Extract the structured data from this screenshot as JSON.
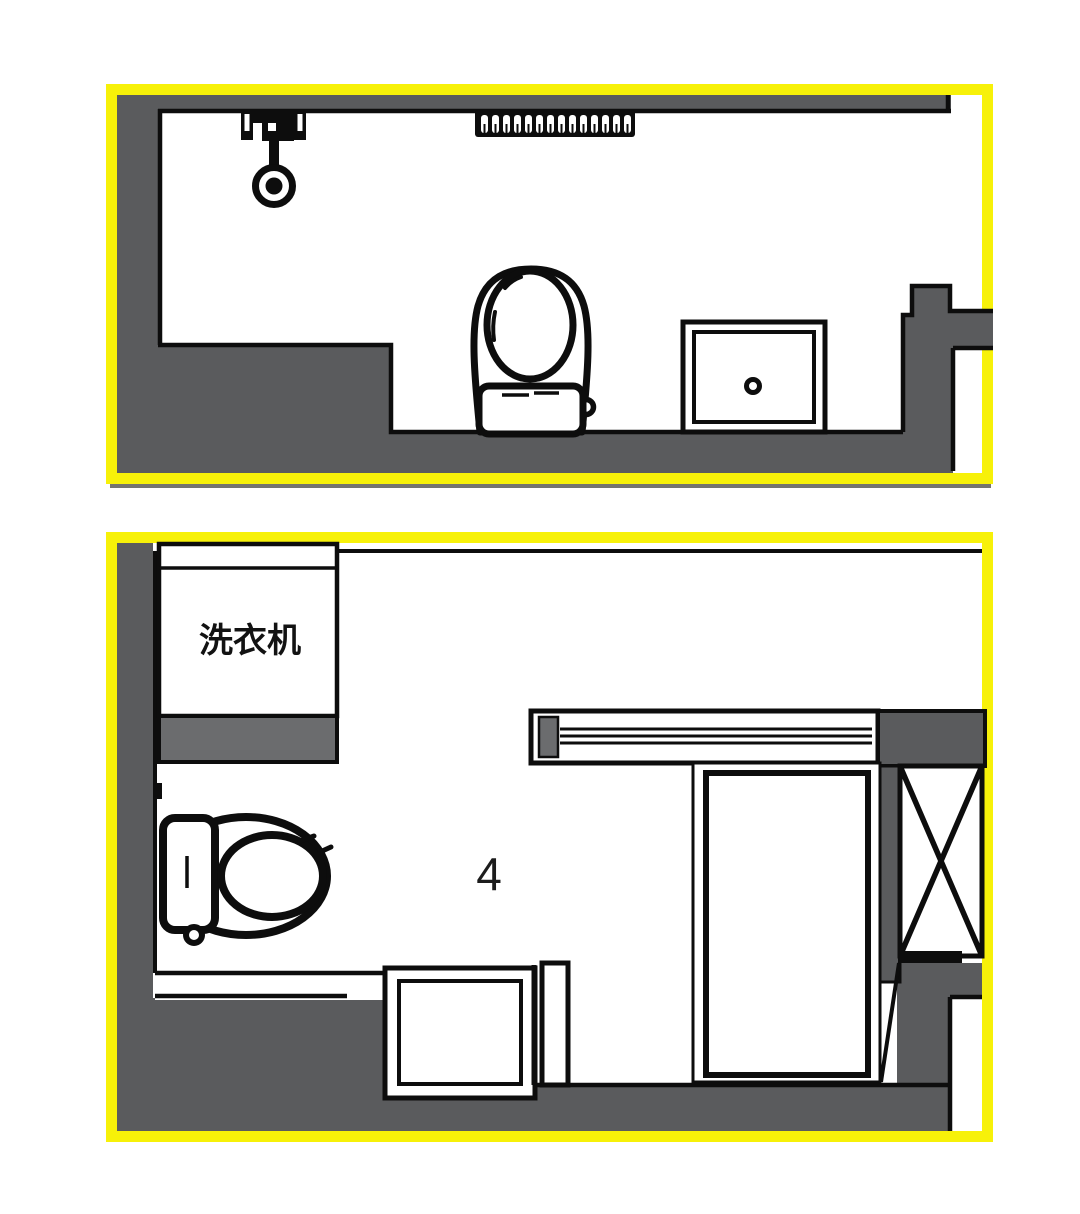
{
  "document": {
    "kind": "bathroom-floor-plan-comparison",
    "panel_count": 2
  },
  "panels": {
    "top": {
      "fixtures": {
        "shower": "shower-head",
        "radiator": "towel-radiator",
        "toilet": "toilet",
        "basin": "wash-basin"
      }
    },
    "bottom": {
      "washing_machine_label": "洗衣机",
      "zone_label": "4",
      "fixtures": {
        "washing_machine": "washing-machine",
        "toilet": "toilet",
        "basin": "wash-basin",
        "sliding_door": "sliding-door-track",
        "shower_stall": "shower-stall",
        "shaft": "x-braced-shaft"
      }
    }
  },
  "colors": {
    "frame_yellow": "#F7F109",
    "wall_gray": "#5A5B5D",
    "block_gray": "#6B6C6E",
    "line_black": "#0D0D0D",
    "paper_white": "#FFFFFF"
  }
}
